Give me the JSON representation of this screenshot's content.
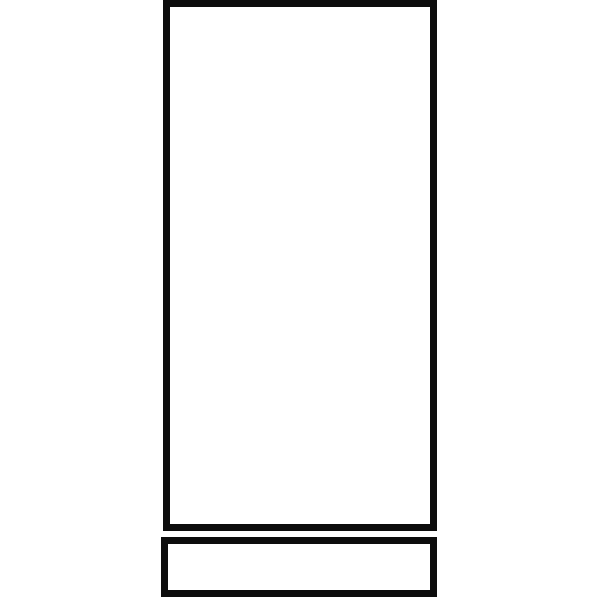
{
  "canvas": {
    "width": 600,
    "height": 600,
    "background_color": "#ffffff"
  },
  "drawing": {
    "stroke_color": "#0d0d0d",
    "fill_color": "#ffffff",
    "shapes": [
      {
        "id": "tall-rectangle",
        "type": "rectangle",
        "x": 163,
        "y": 0,
        "width": 274,
        "height": 531,
        "stroke_width": 7
      },
      {
        "id": "base-rectangle",
        "type": "rectangle",
        "x": 161,
        "y": 537,
        "width": 276,
        "height": 60,
        "stroke_width": 7
      }
    ]
  }
}
